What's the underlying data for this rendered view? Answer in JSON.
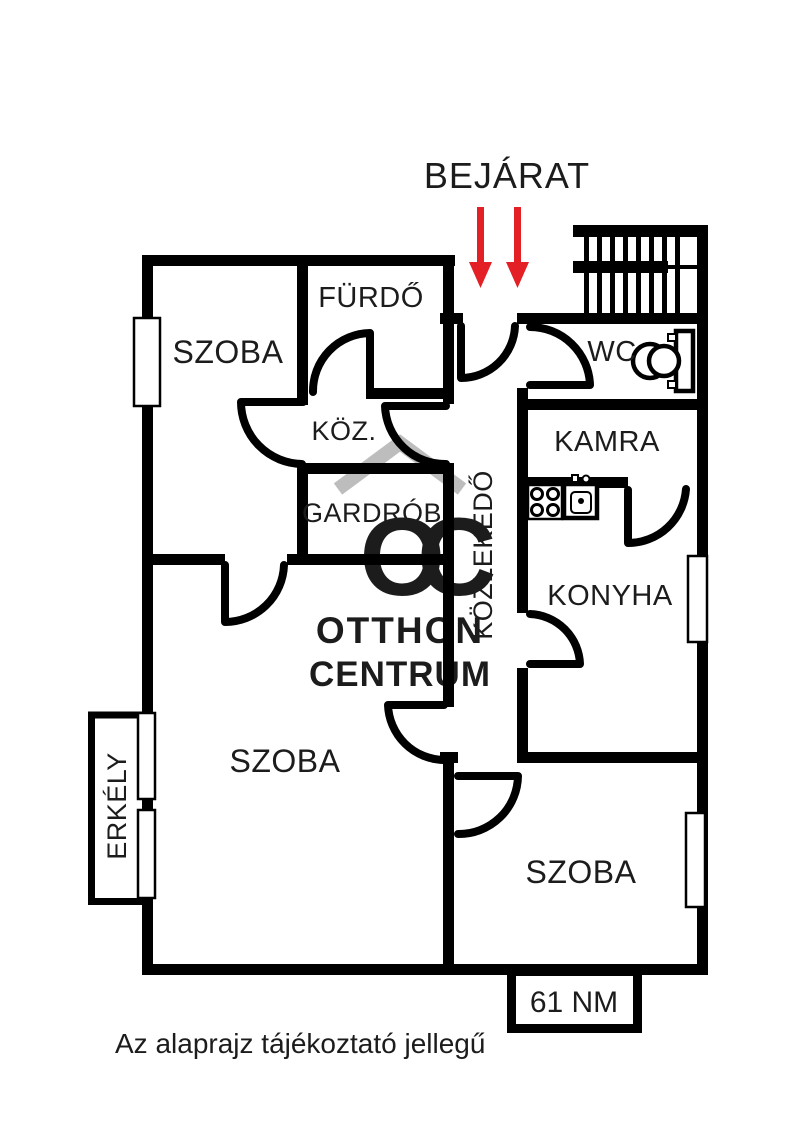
{
  "header": {
    "entrance_label": "BEJÁRAT"
  },
  "rooms": {
    "szoba_top": "SZOBA",
    "furdo": "FÜRDŐ",
    "koz": "KÖZ.",
    "gardrob": "GARDRÓB",
    "kozlekedo": "KÖZLEKEDŐ",
    "wc": "WC",
    "kamra": "KAMRA",
    "konyha": "KONYHA",
    "szoba_large": "SZOBA",
    "szoba_bottom": "SZOBA",
    "erkely": "ERKÉLY"
  },
  "area_badge": "61 NM",
  "disclaimer": "Az alaprajz tájékoztató jellegű",
  "watermark": {
    "monogram": "OC",
    "line1": "OTTHON",
    "line2": "CENTRUM"
  },
  "colors": {
    "wall": "#000000",
    "arrow_red": "#e32025",
    "watermark_gray": "#bdbdbd",
    "text": "#1c1c1c"
  }
}
